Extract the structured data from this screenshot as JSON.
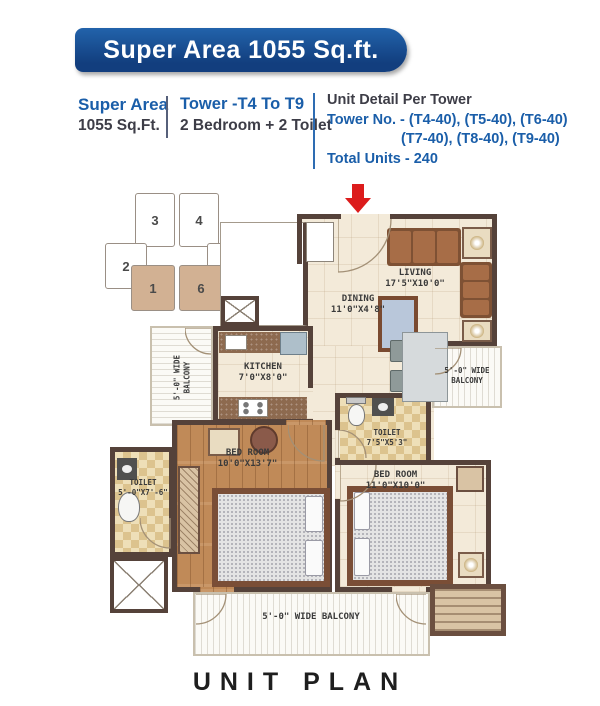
{
  "banner": {
    "title": "Super Area 1055 Sq.ft."
  },
  "info": {
    "super_area_label": "Super Area",
    "super_area_value": "1055 Sq.Ft.",
    "tower_range": "Tower -T4 To T9",
    "configuration": "2 Bedroom + 2 Toilet",
    "unit_detail_title": "Unit Detail Per Tower",
    "tower_numbers_line1": "Tower No. - (T4-40), (T5-40), (T6-40)",
    "tower_numbers_line2": "(T7-40), (T8-40), (T9-40)",
    "total_units": "Total Units - 240"
  },
  "key_plan": {
    "units": [
      "3",
      "4",
      "2",
      "5",
      "1",
      "6"
    ],
    "highlighted_units": [
      "1",
      "6"
    ]
  },
  "plan": {
    "living": {
      "name": "LIVING",
      "dims": "17'5\"X10'0\""
    },
    "dining": {
      "name": "DINING",
      "dims": "11'0\"X4'8\""
    },
    "kitchen": {
      "name": "KITCHEN",
      "dims": "7'0\"X8'0\""
    },
    "toilet_right": {
      "name": "TOILET",
      "dims": "7'5\"X5'3\""
    },
    "toilet_left": {
      "name": "TOILET",
      "dims": "5'-0\"X7'-6\""
    },
    "bedroom_left": {
      "name": "BED ROOM",
      "dims": "10'0\"X13'7\""
    },
    "bedroom_right": {
      "name": "BED ROOM",
      "dims": "11'0\"X10'0\""
    },
    "balcony_left": {
      "line1": "5'-0\" WIDE",
      "line2": "BALCONY"
    },
    "balcony_right": {
      "line1": "5'-0\" WIDE",
      "line2": "BALCONY"
    },
    "balcony_bottom": {
      "label": "5'-0\" WIDE BALCONY"
    }
  },
  "footer": {
    "title": "UNIT PLAN"
  },
  "colors": {
    "banner_blue": "#17508f",
    "accent_blue": "#1a5ea9",
    "wall_brown": "#55423a",
    "highlighted_unit_tan": "#d2b193",
    "entry_arrow_red": "#dc1c1c"
  }
}
